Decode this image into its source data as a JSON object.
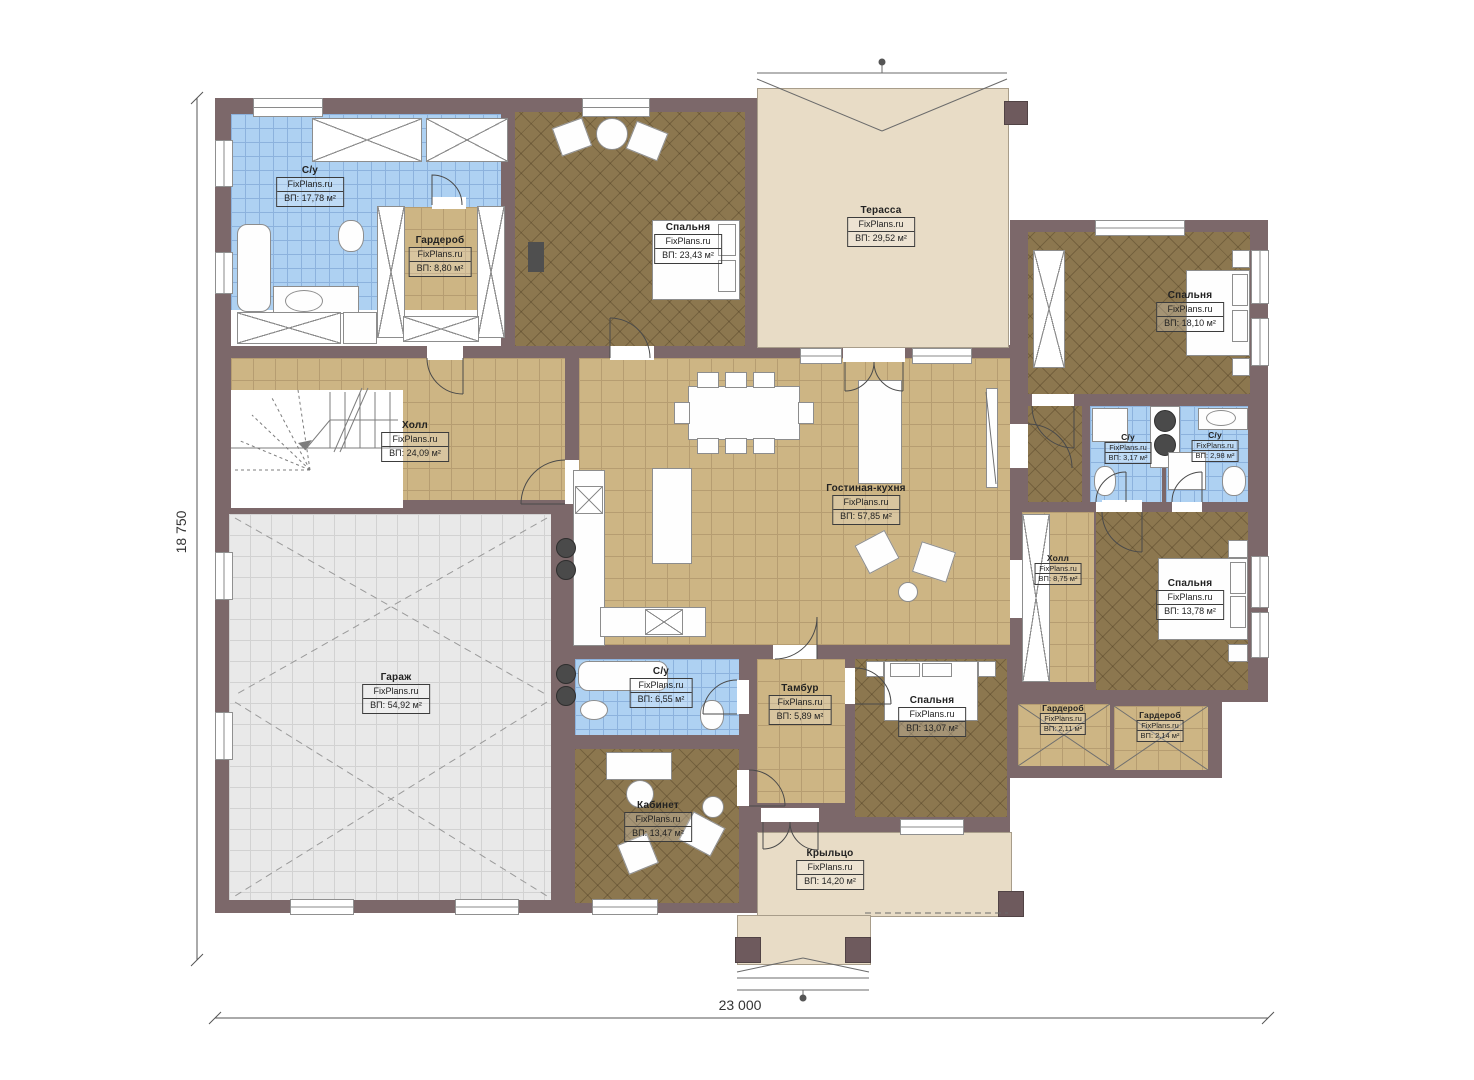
{
  "plan": {
    "watermark": "FixPlans.ru",
    "dimensions": {
      "height_label": "18 750",
      "width_label": "23 000"
    },
    "colors": {
      "wall": "#7c686a",
      "floor_wood": "#8c774f",
      "floor_tile": "#cdb584",
      "floor_blue": "#aed1f2",
      "floor_beige": "#e8dcc6",
      "floor_garage": "#e9e9e9"
    },
    "rooms": [
      {
        "id": "bathroom-1",
        "name": "С/у",
        "area": "ВП: 17,78 м²"
      },
      {
        "id": "wardrobe-1",
        "name": "Гардероб",
        "area": "ВП: 8,80 м²"
      },
      {
        "id": "bedroom-1",
        "name": "Спальня",
        "area": "ВП: 23,43 м²"
      },
      {
        "id": "terrace",
        "name": "Терасса",
        "area": "ВП: 29,52 м²"
      },
      {
        "id": "bedroom-2",
        "name": "Спальня",
        "area": "ВП: 18,10 м²"
      },
      {
        "id": "hall-1",
        "name": "Холл",
        "area": "ВП: 24,09 м²"
      },
      {
        "id": "living-kitchen",
        "name": "Гостиная-кухня",
        "area": "ВП: 57,85 м²"
      },
      {
        "id": "bathroom-2",
        "name": "С/у",
        "area": "ВП: 3,17 м²"
      },
      {
        "id": "bathroom-3",
        "name": "С/у",
        "area": "ВП: 2,98 м²"
      },
      {
        "id": "hall-2",
        "name": "Холл",
        "area": "ВП: 8,75 м²"
      },
      {
        "id": "bedroom-3",
        "name": "Спальня",
        "area": "ВП: 13,78 м²"
      },
      {
        "id": "garage",
        "name": "Гараж",
        "area": "ВП: 54,92 м²"
      },
      {
        "id": "bathroom-4",
        "name": "С/у",
        "area": "ВП: 6,55 м²"
      },
      {
        "id": "tambour",
        "name": "Тамбур",
        "area": "ВП: 5,89 м²"
      },
      {
        "id": "bedroom-4",
        "name": "Спальня",
        "area": "ВП: 13,07 м²"
      },
      {
        "id": "wardrobe-2",
        "name": "Гардероб",
        "area": "ВП: 2,11 м²"
      },
      {
        "id": "wardrobe-3",
        "name": "Гардероб",
        "area": "ВП: 2,14 м²"
      },
      {
        "id": "office",
        "name": "Кабинет",
        "area": "ВП: 13,47 м²"
      },
      {
        "id": "porch",
        "name": "Крыльцо",
        "area": "ВП: 14,20 м²"
      }
    ]
  }
}
